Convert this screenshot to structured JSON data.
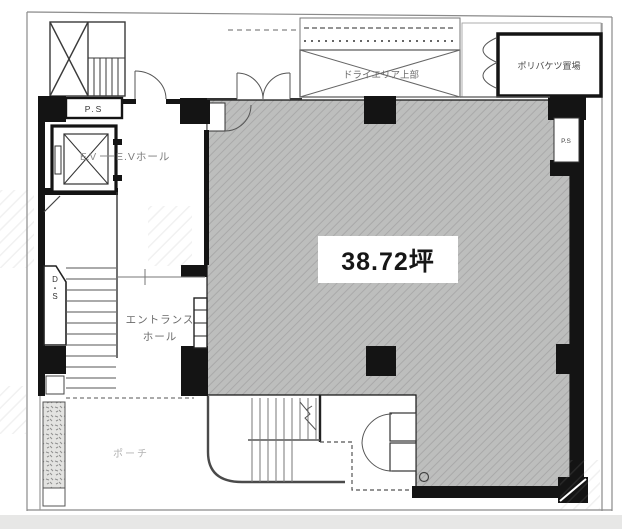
{
  "labels": {
    "area": "38.72坪",
    "ps_top": "P.S",
    "ps_right": "P.S",
    "duct_space": "D・S",
    "elevator": "E.V",
    "elevator_hall": "E.Vホール",
    "entrance_hall": {
      "line1": "エントランス",
      "line2": "ホール"
    },
    "porch": "ポーチ",
    "dry_area_upper": "ドライエリア上部",
    "bucket_storage": "ポリバケツ置場"
  },
  "colors": {
    "tenant_fill": "#bdbebd",
    "tenant_hatch": "#a9a9a9",
    "wall": "#141414",
    "line": "#555555",
    "boundary": "#8a8a8a",
    "faint_text": "#b3b3b3"
  }
}
